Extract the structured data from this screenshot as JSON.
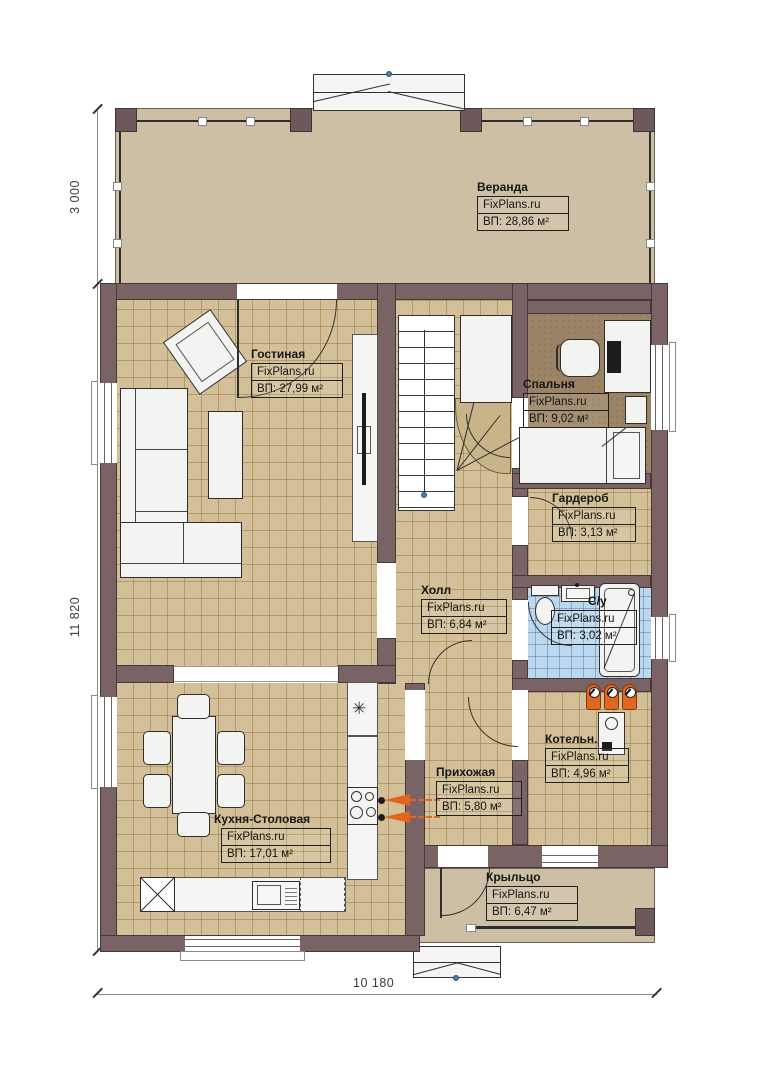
{
  "brand": "FixPlans.ru",
  "rooms": {
    "veranda": {
      "name": "Веранда",
      "area": "ВП: 28,86 м²"
    },
    "living": {
      "name": "Гостиная",
      "area": "ВП: 27,99 м²"
    },
    "bedroom": {
      "name": "Спальня",
      "area": "ВП: 9,02 м²"
    },
    "wardrobe": {
      "name": "Гардероб",
      "area": "ВП: 3,13 м²"
    },
    "hall": {
      "name": "Холл",
      "area": "ВП: 6,84 м²"
    },
    "bathroom": {
      "name": "С/у",
      "area": "ВП: 3,02 м²"
    },
    "boiler": {
      "name": "Котельн.",
      "area": "ВП: 4,96 м²"
    },
    "entry": {
      "name": "Прихожая",
      "area": "ВП: 5,80 м²"
    },
    "kitchen": {
      "name": "Кухня-Столовая",
      "area": "ВП: 17,01 м²"
    },
    "porch": {
      "name": "Крыльцо",
      "area": "ВП: 6,47 м²"
    }
  },
  "dimensions": {
    "veranda_depth": "3 000",
    "house_height": "11 820",
    "house_width": "10 180"
  },
  "symbols": {
    "stove_vent": "✳"
  },
  "colors": {
    "wall": "#7a6364",
    "tile_floor": "#d3c098",
    "bedroom_floor": "#9b8465",
    "bath_floor": "#bcd8ee",
    "veranda_floor": "#cdbfa3",
    "accent_orange": "#e2661f"
  }
}
